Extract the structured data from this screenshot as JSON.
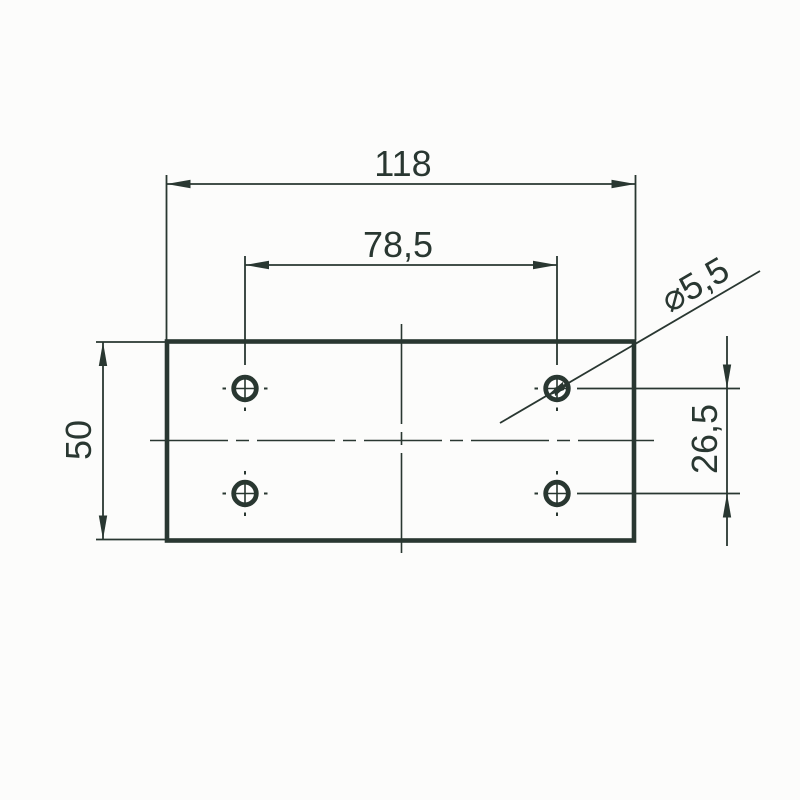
{
  "drawing": {
    "kind": "technical-dimension-drawing",
    "part": "rectangular mounting plate with 4 holes",
    "hole_count": 4
  },
  "labels": {
    "plate_width": "118",
    "hole_spacing_x": "78,5",
    "plate_height": "50",
    "hole_spacing_y": "26,5",
    "hole_diameter": "⌀5,5"
  },
  "colors": {
    "ink": "#293731",
    "background": "#fcfcfb"
  }
}
